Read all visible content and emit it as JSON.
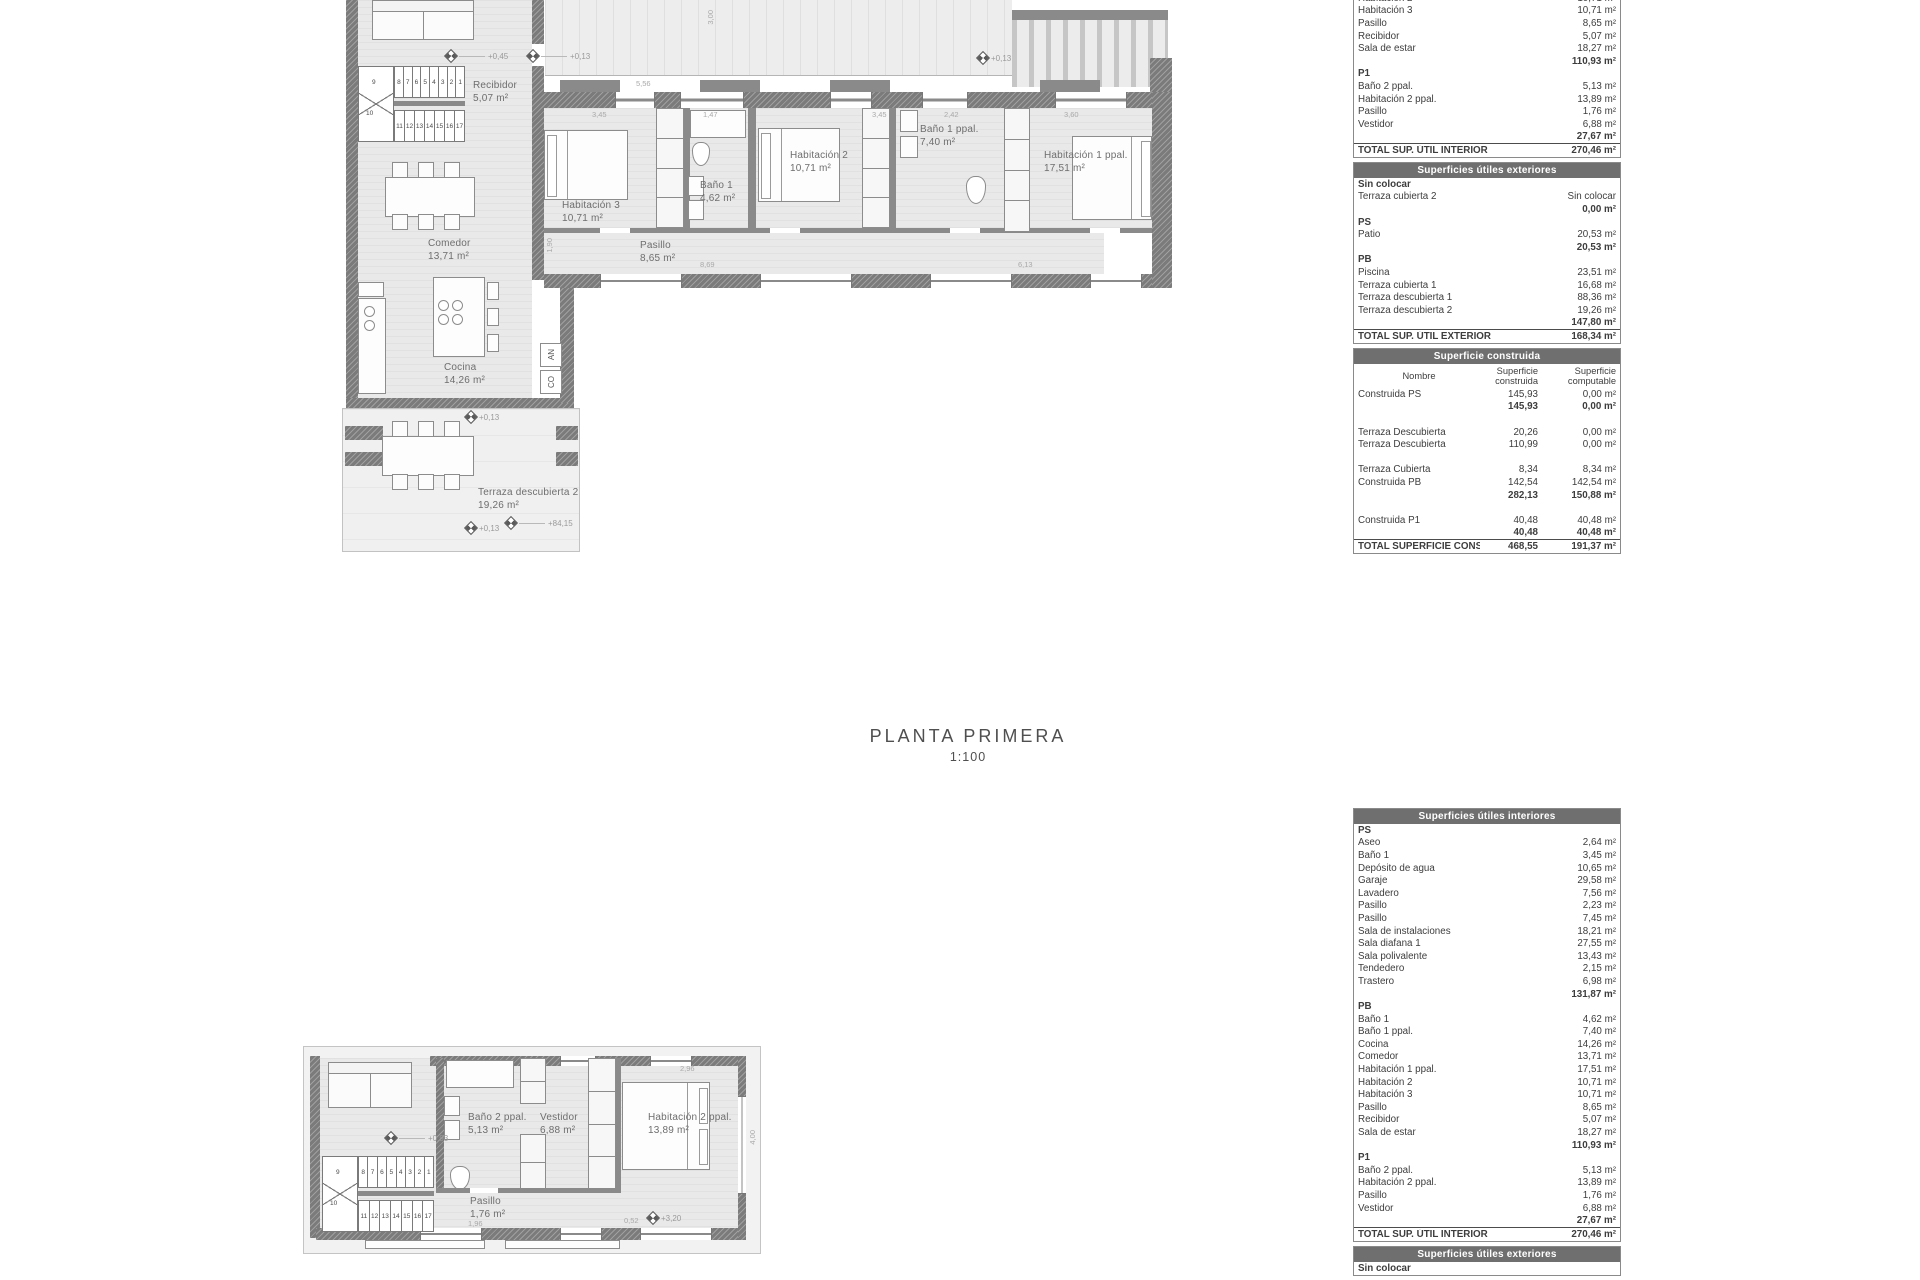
{
  "title": {
    "main": "PLANTA PRIMERA",
    "scale": "1:100"
  },
  "plan_pb": {
    "rooms": {
      "recibidor": {
        "name": "Recibidor",
        "area": "5,07 m²"
      },
      "comedor": {
        "name": "Comedor",
        "area": "13,71 m²"
      },
      "cocina": {
        "name": "Cocina",
        "area": "14,26 m²"
      },
      "pasillo": {
        "name": "Pasillo",
        "area": "8,65 m²"
      },
      "hab3": {
        "name": "Habitación 3",
        "area": "10,71 m²"
      },
      "bano1": {
        "name": "Baño 1",
        "area": "4,62 m²"
      },
      "hab2": {
        "name": "Habitación 2",
        "area": "10,71 m²"
      },
      "bano1ppal": {
        "name": "Baño 1 ppal.",
        "area": "7,40 m²"
      },
      "hab1ppal": {
        "name": "Habitación 1 ppal.",
        "area": "17,51 m²"
      },
      "terraza2": {
        "name": "Terraza descubierta 2",
        "area": "19,26 m²"
      }
    },
    "levels": {
      "l1": "+0,45",
      "l2": "+0,13",
      "l3": "+0,13",
      "l4": "+0,13",
      "l5": "+84,15",
      "l6": "+0,13"
    },
    "dims": {
      "d1": "3,45",
      "d2": "1,47",
      "d3": "3,45",
      "d4": "2,42",
      "d5": "3,60",
      "d6": "5,56",
      "d7": "3,00",
      "d8": "8,69",
      "d9": "6,13",
      "d10": "1,90"
    },
    "stairs": {
      "top": [
        "8",
        "7",
        "6",
        "5",
        "4",
        "3",
        "2",
        "1"
      ],
      "mid": [
        "9",
        "10"
      ],
      "bottom": [
        "11",
        "12",
        "13",
        "14",
        "15",
        "16",
        "17"
      ]
    },
    "annotations": {
      "an": "AN",
      "co": "CO"
    }
  },
  "plan_p1": {
    "rooms": {
      "bano2ppal": {
        "name": "Baño 2 ppal.",
        "area": "5,13 m²"
      },
      "vestidor": {
        "name": "Vestidor",
        "area": "6,88 m²"
      },
      "hab2ppal": {
        "name": "Habitación 2 ppal.",
        "area": "13,89 m²"
      },
      "pasillo": {
        "name": "Pasillo",
        "area": "1,76 m²"
      }
    },
    "levels": {
      "l1": "+0,93",
      "l2": "+3,20"
    },
    "dims": {
      "d1": "2,96",
      "d2": "4,00",
      "d3": "1,96",
      "d4": "0,52"
    },
    "stairs": {
      "top": [
        "8",
        "7",
        "6",
        "5",
        "4",
        "3",
        "2",
        "1"
      ],
      "mid": [
        "9",
        "10"
      ],
      "bottom": [
        "11",
        "12",
        "13",
        "14",
        "15",
        "16",
        "17"
      ]
    }
  },
  "tables": {
    "interior_top": {
      "cols": 2,
      "rows": [
        {
          "t": "row",
          "l": "Habitación 2",
          "v": "10,71 m²"
        },
        {
          "t": "row",
          "l": "Habitación 3",
          "v": "10,71 m²"
        },
        {
          "t": "row",
          "l": "Pasillo",
          "v": "8,65 m²"
        },
        {
          "t": "row",
          "l": "Recibidor",
          "v": "5,07 m²"
        },
        {
          "t": "row",
          "l": "Sala de estar",
          "v": "18,27 m²"
        },
        {
          "t": "sub",
          "v": "110,93 m²"
        },
        {
          "t": "sec",
          "l": "P1"
        },
        {
          "t": "row",
          "l": "Baño 2 ppal.",
          "v": "5,13 m²"
        },
        {
          "t": "row",
          "l": "Habitación 2 ppal.",
          "v": "13,89 m²"
        },
        {
          "t": "row",
          "l": "Pasillo",
          "v": "1,76 m²"
        },
        {
          "t": "row",
          "l": "Vestidor",
          "v": "6,88 m²"
        },
        {
          "t": "sub",
          "v": "27,67 m²"
        },
        {
          "t": "total",
          "l": "TOTAL SUP.  ÚTIL INTERIOR",
          "v": "270,46 m²"
        }
      ]
    },
    "exterior_top": {
      "title": "Superficies útiles exteriores",
      "cols": 2,
      "rows": [
        {
          "t": "sec",
          "l": "Sin colocar"
        },
        {
          "t": "row",
          "l": "Terraza cubierta 2",
          "v": "Sin colocar"
        },
        {
          "t": "sub",
          "v": "0,00 m²"
        },
        {
          "t": "sec",
          "l": "PS"
        },
        {
          "t": "row",
          "l": "Patio",
          "v": "20,53 m²"
        },
        {
          "t": "sub",
          "v": "20,53 m²"
        },
        {
          "t": "sec",
          "l": "PB"
        },
        {
          "t": "row",
          "l": "Piscina",
          "v": "23,51 m²"
        },
        {
          "t": "row",
          "l": "Terraza cubierta 1",
          "v": "16,68 m²"
        },
        {
          "t": "row",
          "l": "Terraza descubierta 1",
          "v": "88,36 m²"
        },
        {
          "t": "row",
          "l": "Terraza descubierta 2",
          "v": "19,26 m²"
        },
        {
          "t": "sub",
          "v": "147,80 m²"
        },
        {
          "t": "total",
          "l": "TOTAL SUP.  ÚTIL EXTERIOR",
          "v": "168,34 m²"
        }
      ]
    },
    "construida": {
      "title": "Superficie construida",
      "cols": 3,
      "colhead": [
        "Nombre",
        "Superficie\nconstruida",
        "Superficie\ncomputable"
      ],
      "rows": [
        {
          "t": "row",
          "l": "Construida PS",
          "v1": "145,93",
          "v2": "0,00 m²"
        },
        {
          "t": "sub",
          "v1": "145,93",
          "v2": "0,00 m²"
        },
        {
          "t": "gap"
        },
        {
          "t": "row",
          "l": "Terraza Descubierta",
          "v1": "20,26",
          "v2": "0,00 m²"
        },
        {
          "t": "row",
          "l": "Terraza Descubierta",
          "v1": "110,99",
          "v2": "0,00 m²"
        },
        {
          "t": "gap"
        },
        {
          "t": "row",
          "l": "Terraza Cubierta",
          "v1": "8,34",
          "v2": "8,34 m²"
        },
        {
          "t": "row",
          "l": "Construida PB",
          "v1": "142,54",
          "v2": "142,54 m²"
        },
        {
          "t": "sub",
          "v1": "282,13",
          "v2": "150,88 m²"
        },
        {
          "t": "gap"
        },
        {
          "t": "row",
          "l": "Construida P1",
          "v1": "40,48",
          "v2": "40,48 m²"
        },
        {
          "t": "sub",
          "v1": "40,48",
          "v2": "40,48 m²"
        },
        {
          "t": "total",
          "l": "TOTAL SUPERFICIE CONSTRUIDA:",
          "v1": "468,55",
          "v2": "191,37 m²"
        }
      ]
    },
    "interior_bottom": {
      "title": "Superficies útiles interiores",
      "cols": 2,
      "rows": [
        {
          "t": "sec",
          "l": "PS"
        },
        {
          "t": "row",
          "l": "Aseo",
          "v": "2,64 m²"
        },
        {
          "t": "row",
          "l": "Baño 1",
          "v": "3,45 m²"
        },
        {
          "t": "row",
          "l": "Depósito de agua",
          "v": "10,65 m²"
        },
        {
          "t": "row",
          "l": "Garaje",
          "v": "29,58 m²"
        },
        {
          "t": "row",
          "l": "Lavadero",
          "v": "7,56 m²"
        },
        {
          "t": "row",
          "l": "Pasillo",
          "v": "2,23 m²"
        },
        {
          "t": "row",
          "l": "Pasillo",
          "v": "7,45 m²"
        },
        {
          "t": "row",
          "l": "Sala de instalaciones",
          "v": "18,21 m²"
        },
        {
          "t": "row",
          "l": "Sala diafana 1",
          "v": "27,55 m²"
        },
        {
          "t": "row",
          "l": "Sala polivalente",
          "v": "13,43 m²"
        },
        {
          "t": "row",
          "l": "Tendedero",
          "v": "2,15 m²"
        },
        {
          "t": "row",
          "l": "Trastero",
          "v": "6,98 m²"
        },
        {
          "t": "sub",
          "v": "131,87 m²"
        },
        {
          "t": "sec",
          "l": "PB"
        },
        {
          "t": "row",
          "l": "Baño 1",
          "v": "4,62 m²"
        },
        {
          "t": "row",
          "l": "Baño 1 ppal.",
          "v": "7,40 m²"
        },
        {
          "t": "row",
          "l": "Cocina",
          "v": "14,26 m²"
        },
        {
          "t": "row",
          "l": "Comedor",
          "v": "13,71 m²"
        },
        {
          "t": "row",
          "l": "Habitación 1 ppal.",
          "v": "17,51 m²"
        },
        {
          "t": "row",
          "l": "Habitación 2",
          "v": "10,71 m²"
        },
        {
          "t": "row",
          "l": "Habitación 3",
          "v": "10,71 m²"
        },
        {
          "t": "row",
          "l": "Pasillo",
          "v": "8,65 m²"
        },
        {
          "t": "row",
          "l": "Recibidor",
          "v": "5,07 m²"
        },
        {
          "t": "row",
          "l": "Sala de estar",
          "v": "18,27 m²"
        },
        {
          "t": "sub",
          "v": "110,93 m²"
        },
        {
          "t": "sec",
          "l": "P1"
        },
        {
          "t": "row",
          "l": "Baño 2 ppal.",
          "v": "5,13 m²"
        },
        {
          "t": "row",
          "l": "Habitación 2 ppal.",
          "v": "13,89 m²"
        },
        {
          "t": "row",
          "l": "Pasillo",
          "v": "1,76 m²"
        },
        {
          "t": "row",
          "l": "Vestidor",
          "v": "6,88 m²"
        },
        {
          "t": "sub",
          "v": "27,67 m²"
        },
        {
          "t": "total",
          "l": "TOTAL SUP.  ÚTIL INTERIOR",
          "v": "270,46 m²"
        }
      ]
    },
    "exterior_bottom": {
      "title": "Superficies útiles exteriores",
      "cols": 2,
      "rows": [
        {
          "t": "sec",
          "l": "Sin colocar"
        }
      ]
    }
  }
}
